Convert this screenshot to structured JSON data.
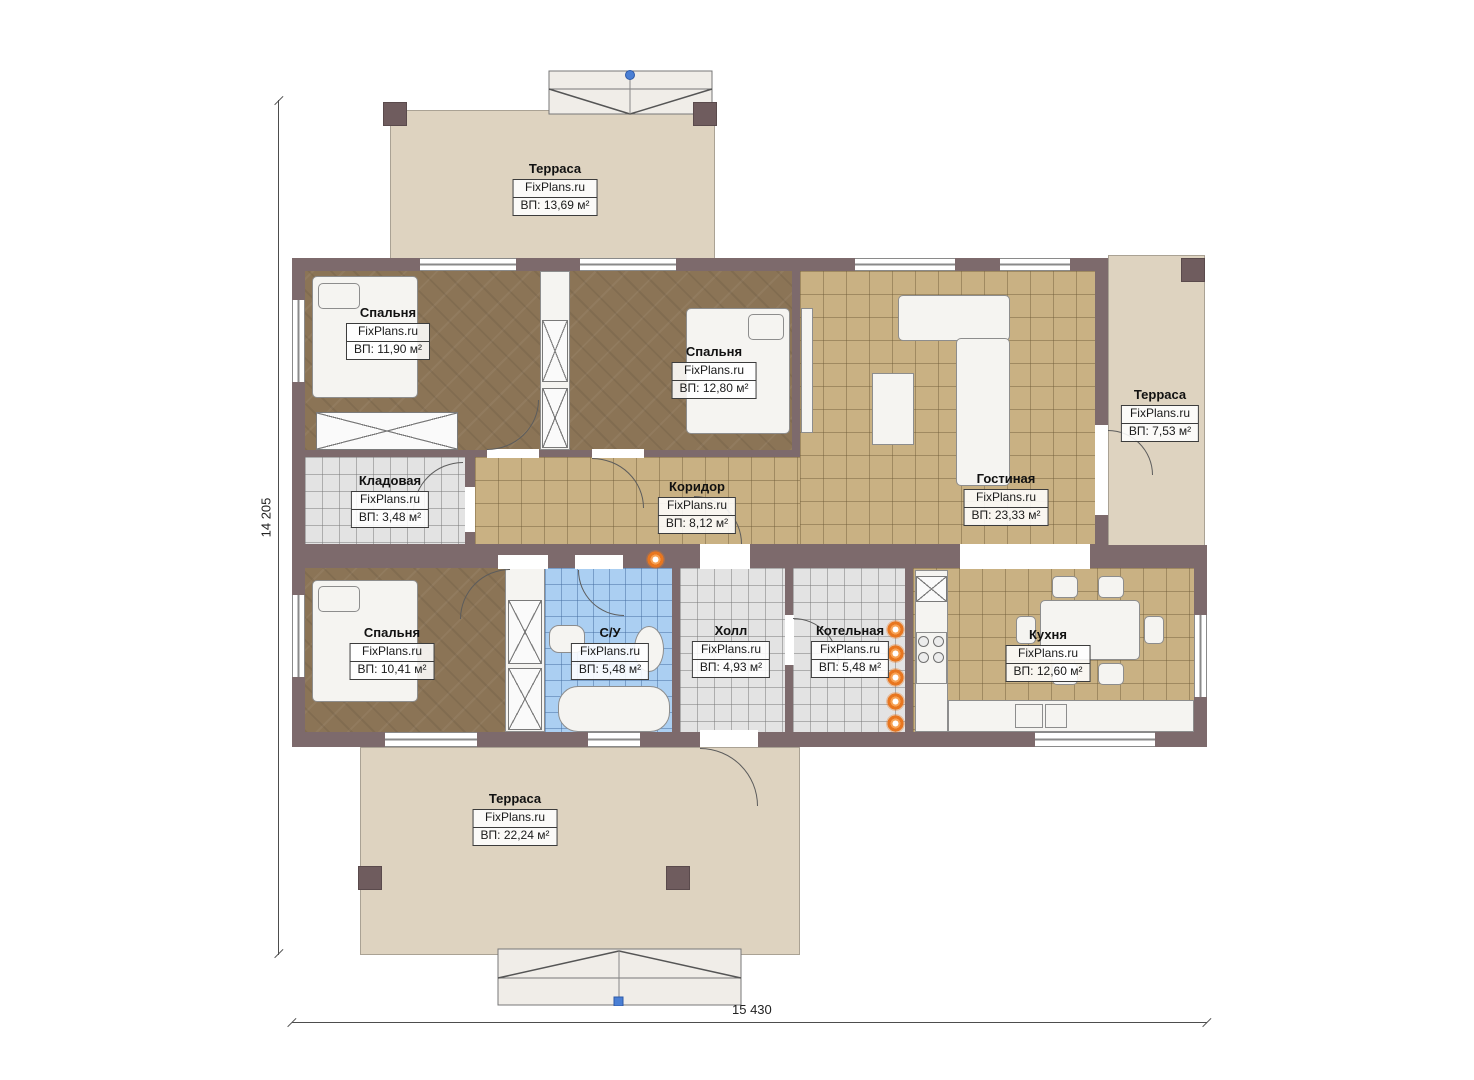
{
  "plan": {
    "brand": "FixPlans.ru",
    "dimension_width": "15 430",
    "dimension_height": "14 205",
    "rooms": [
      {
        "id": "terrace-top",
        "name": "Терраса",
        "area": "ВП: 13,69 м²"
      },
      {
        "id": "bedroom-1",
        "name": "Спальня",
        "area": "ВП: 11,90 м²"
      },
      {
        "id": "bedroom-2",
        "name": "Спальня",
        "area": "ВП: 12,80 м²"
      },
      {
        "id": "storage",
        "name": "Кладовая",
        "area": "ВП: 3,48 м²"
      },
      {
        "id": "corridor",
        "name": "Коридор",
        "area": "ВП: 8,12 м²"
      },
      {
        "id": "living-room",
        "name": "Гостиная",
        "area": "ВП: 23,33 м²"
      },
      {
        "id": "terrace-right",
        "name": "Терраса",
        "area": "ВП: 7,53 м²"
      },
      {
        "id": "bedroom-3",
        "name": "Спальня",
        "area": "ВП: 10,41 м²"
      },
      {
        "id": "bathroom",
        "name": "С/У",
        "area": "ВП: 5,48 м²"
      },
      {
        "id": "hall",
        "name": "Холл",
        "area": "ВП: 4,93 м²"
      },
      {
        "id": "boiler-room",
        "name": "Котельная",
        "area": "ВП: 5,48 м²"
      },
      {
        "id": "kitchen",
        "name": "Кухня",
        "area": "ВП: 12,60 м²"
      },
      {
        "id": "terrace-bottom",
        "name": "Терраса",
        "area": "ВП: 22,24 м²"
      }
    ],
    "colors": {
      "wall": "#7d6a6c",
      "terrace": "#ded3c0",
      "floor_wood": "#8b7456",
      "floor_tile_tan": "#c9b183",
      "floor_tile_gray": "#e3e3e3",
      "floor_tile_blue": "#abcff2",
      "accent_orange": "#e8761f",
      "entry_marker_blue": "#4a7fd4"
    }
  }
}
